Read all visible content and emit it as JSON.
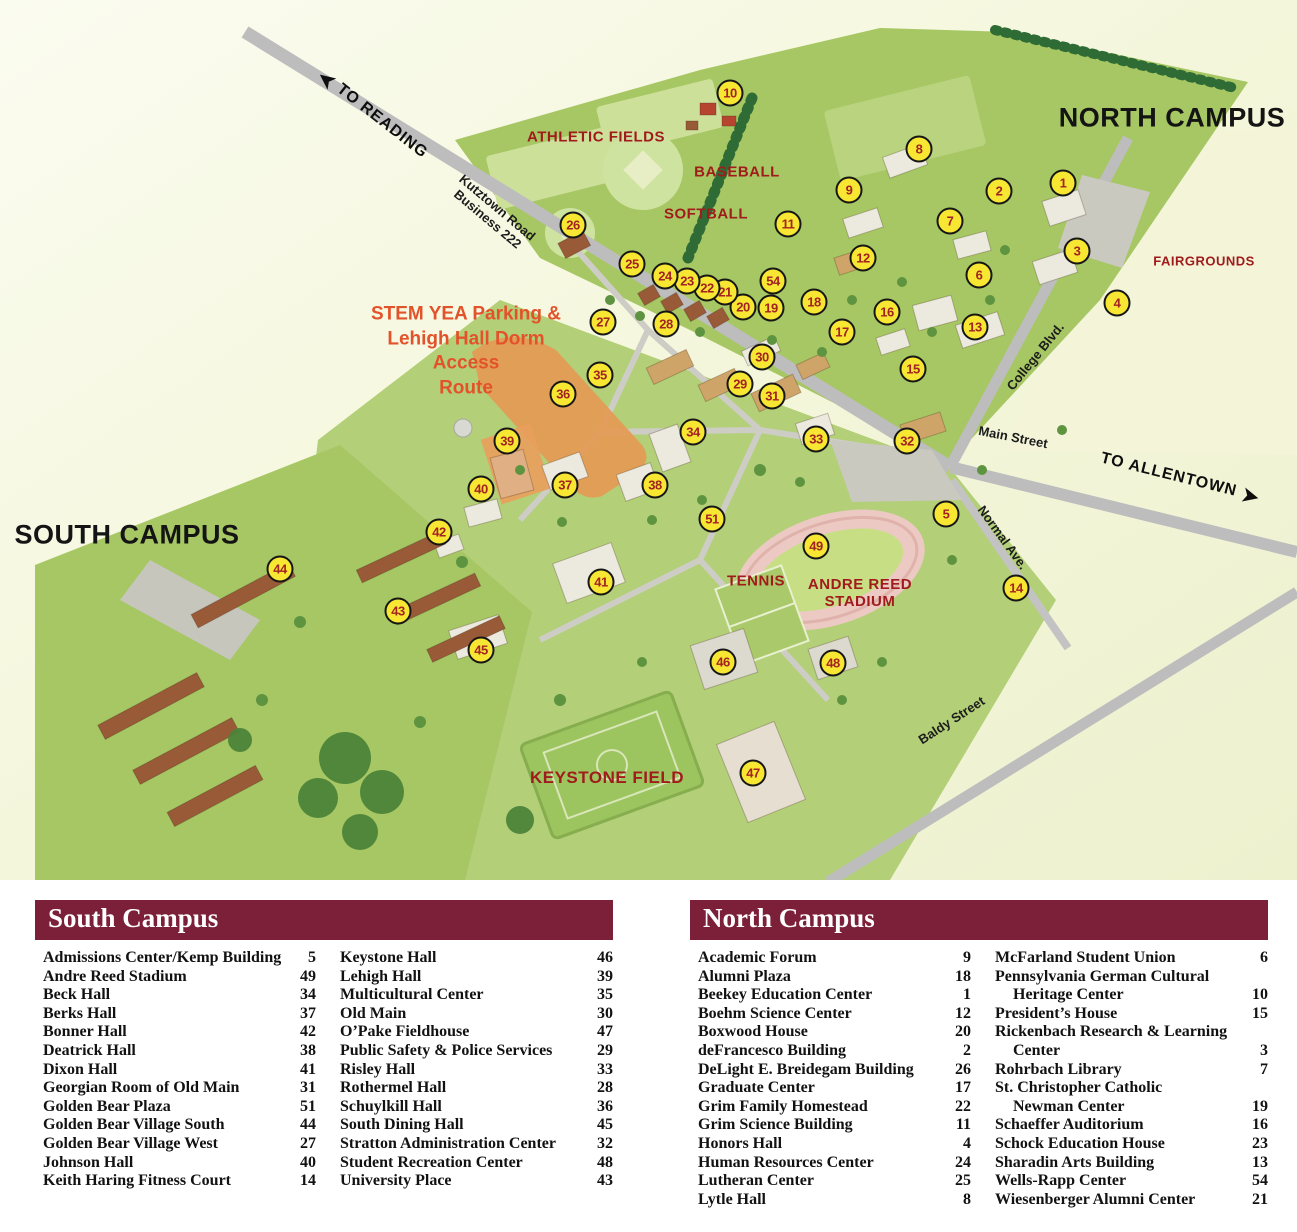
{
  "map": {
    "colors": {
      "marker_fill": "#F7E733",
      "marker_number": "#A32222",
      "red_label": "#A01C1C",
      "stem_orange": "#E2532B",
      "legend_header": "#7C2039",
      "road_gray": "#BDBDBD",
      "green_main": "#A6C763",
      "green_band": "#B3CF78"
    },
    "labels": [
      {
        "lines": [
          "TO READING"
        ],
        "x": 372,
        "y": 115,
        "rot": 38,
        "style": "route",
        "arrow": "before"
      },
      {
        "lines": [
          "Kutztown Road",
          "Business 222"
        ],
        "x": 492,
        "y": 214,
        "rot": 40,
        "style": "street"
      },
      {
        "lines": [
          "NORTH CAMPUS"
        ],
        "x": 1172,
        "y": 118,
        "rot": 0,
        "style": "campus"
      },
      {
        "lines": [
          "ATHLETIC FIELDS"
        ],
        "x": 596,
        "y": 137,
        "rot": 0,
        "style": "red"
      },
      {
        "lines": [
          "BASEBALL"
        ],
        "x": 737,
        "y": 172,
        "rot": 0,
        "style": "red"
      },
      {
        "lines": [
          "SOFTBALL"
        ],
        "x": 706,
        "y": 214,
        "rot": 0,
        "style": "red"
      },
      {
        "lines": [
          "FAIRGROUNDS"
        ],
        "x": 1204,
        "y": 262,
        "rot": 0,
        "style": "red-small"
      },
      {
        "lines": [
          "STEM YEA Parking &",
          "Lehigh Hall Dorm",
          "Access",
          "Route"
        ],
        "x": 466,
        "y": 352,
        "rot": 0,
        "style": "stem"
      },
      {
        "lines": [
          "College Blvd."
        ],
        "x": 1036,
        "y": 357,
        "rot": -51,
        "style": "street"
      },
      {
        "lines": [
          "Main Street"
        ],
        "x": 1013,
        "y": 438,
        "rot": 11,
        "style": "street"
      },
      {
        "lines": [
          "TO ALLENTOWN"
        ],
        "x": 1180,
        "y": 479,
        "rot": 14,
        "style": "route",
        "arrow": "after"
      },
      {
        "lines": [
          "SOUTH CAMPUS"
        ],
        "x": 127,
        "y": 535,
        "rot": 0,
        "style": "campus"
      },
      {
        "lines": [
          "Normal Ave."
        ],
        "x": 1002,
        "y": 538,
        "rot": 54,
        "style": "street"
      },
      {
        "lines": [
          "TENNIS"
        ],
        "x": 756,
        "y": 581,
        "rot": 0,
        "style": "red"
      },
      {
        "lines": [
          "ANDRE REED",
          "STADIUM"
        ],
        "x": 860,
        "y": 593,
        "rot": 0,
        "style": "red"
      },
      {
        "lines": [
          "Baldy Street"
        ],
        "x": 952,
        "y": 721,
        "rot": -33,
        "style": "street"
      },
      {
        "lines": [
          "KEYSTONE FIELD"
        ],
        "x": 607,
        "y": 778,
        "rot": 0,
        "style": "red-big"
      }
    ],
    "markers": [
      {
        "n": "1",
        "x": 1063,
        "y": 183
      },
      {
        "n": "2",
        "x": 999,
        "y": 191
      },
      {
        "n": "3",
        "x": 1077,
        "y": 251
      },
      {
        "n": "4",
        "x": 1117,
        "y": 303
      },
      {
        "n": "5",
        "x": 946,
        "y": 514
      },
      {
        "n": "6",
        "x": 979,
        "y": 275
      },
      {
        "n": "7",
        "x": 950,
        "y": 221
      },
      {
        "n": "8",
        "x": 919,
        "y": 149
      },
      {
        "n": "9",
        "x": 849,
        "y": 190
      },
      {
        "n": "10",
        "x": 730,
        "y": 93
      },
      {
        "n": "11",
        "x": 788,
        "y": 224
      },
      {
        "n": "12",
        "x": 863,
        "y": 258
      },
      {
        "n": "13",
        "x": 975,
        "y": 327
      },
      {
        "n": "14",
        "x": 1016,
        "y": 588
      },
      {
        "n": "15",
        "x": 913,
        "y": 369
      },
      {
        "n": "16",
        "x": 887,
        "y": 312
      },
      {
        "n": "17",
        "x": 842,
        "y": 332
      },
      {
        "n": "18",
        "x": 814,
        "y": 302
      },
      {
        "n": "19",
        "x": 771,
        "y": 308
      },
      {
        "n": "20",
        "x": 743,
        "y": 307
      },
      {
        "n": "21",
        "x": 725,
        "y": 292
      },
      {
        "n": "22",
        "x": 707,
        "y": 288
      },
      {
        "n": "23",
        "x": 687,
        "y": 281
      },
      {
        "n": "24",
        "x": 665,
        "y": 276
      },
      {
        "n": "25",
        "x": 632,
        "y": 264
      },
      {
        "n": "26",
        "x": 573,
        "y": 225
      },
      {
        "n": "27",
        "x": 603,
        "y": 322
      },
      {
        "n": "28",
        "x": 666,
        "y": 324
      },
      {
        "n": "29",
        "x": 740,
        "y": 384
      },
      {
        "n": "30",
        "x": 762,
        "y": 357
      },
      {
        "n": "31",
        "x": 772,
        "y": 396
      },
      {
        "n": "32",
        "x": 907,
        "y": 441
      },
      {
        "n": "33",
        "x": 816,
        "y": 439
      },
      {
        "n": "34",
        "x": 693,
        "y": 432
      },
      {
        "n": "35",
        "x": 600,
        "y": 375
      },
      {
        "n": "36",
        "x": 563,
        "y": 394
      },
      {
        "n": "37",
        "x": 565,
        "y": 485
      },
      {
        "n": "38",
        "x": 655,
        "y": 485
      },
      {
        "n": "39",
        "x": 507,
        "y": 441
      },
      {
        "n": "40",
        "x": 481,
        "y": 489
      },
      {
        "n": "41",
        "x": 601,
        "y": 582
      },
      {
        "n": "42",
        "x": 439,
        "y": 532
      },
      {
        "n": "43",
        "x": 398,
        "y": 611
      },
      {
        "n": "44",
        "x": 280,
        "y": 569
      },
      {
        "n": "45",
        "x": 481,
        "y": 650
      },
      {
        "n": "46",
        "x": 723,
        "y": 662
      },
      {
        "n": "47",
        "x": 753,
        "y": 773
      },
      {
        "n": "48",
        "x": 833,
        "y": 663
      },
      {
        "n": "49",
        "x": 816,
        "y": 546
      },
      {
        "n": "51",
        "x": 712,
        "y": 519
      },
      {
        "n": "54",
        "x": 773,
        "y": 281
      }
    ]
  },
  "legends": [
    {
      "title": "South Campus",
      "columns": [
        [
          {
            "name": "Admissions Center/Kemp Building",
            "num": "5"
          },
          {
            "name": "Andre Reed Stadium",
            "num": "49"
          },
          {
            "name": "Beck Hall",
            "num": "34"
          },
          {
            "name": "Berks Hall",
            "num": "37"
          },
          {
            "name": "Bonner Hall",
            "num": "42"
          },
          {
            "name": "Deatrick Hall",
            "num": "38"
          },
          {
            "name": "Dixon Hall",
            "num": "41"
          },
          {
            "name": "Georgian Room of Old Main",
            "num": "31"
          },
          {
            "name": "Golden Bear Plaza",
            "num": "51"
          },
          {
            "name": "Golden Bear Village South",
            "num": "44"
          },
          {
            "name": "Golden Bear Village West",
            "num": "27"
          },
          {
            "name": "Johnson Hall",
            "num": "40"
          },
          {
            "name": "Keith Haring Fitness Court",
            "num": "14"
          }
        ],
        [
          {
            "name": "Keystone Hall",
            "num": "46"
          },
          {
            "name": "Lehigh Hall",
            "num": "39"
          },
          {
            "name": "Multicultural Center",
            "num": "35"
          },
          {
            "name": "Old Main",
            "num": "30"
          },
          {
            "name": "O’Pake Fieldhouse",
            "num": "47"
          },
          {
            "name": "Public Safety & Police Services",
            "num": "29"
          },
          {
            "name": "Risley Hall",
            "num": "33"
          },
          {
            "name": "Rothermel Hall",
            "num": "28"
          },
          {
            "name": "Schuylkill Hall",
            "num": "36"
          },
          {
            "name": "South Dining Hall",
            "num": "45"
          },
          {
            "name": "Stratton Administration Center",
            "num": "32"
          },
          {
            "name": "Student Recreation Center",
            "num": "48"
          },
          {
            "name": "University Place",
            "num": "43"
          }
        ]
      ]
    },
    {
      "title": "North Campus",
      "columns": [
        [
          {
            "name": "Academic Forum",
            "num": "9"
          },
          {
            "name": "Alumni Plaza",
            "num": "18"
          },
          {
            "name": "Beekey Education Center",
            "num": "1"
          },
          {
            "name": "Boehm Science Center",
            "num": "12"
          },
          {
            "name": "Boxwood House",
            "num": "20"
          },
          {
            "name": "deFrancesco Building",
            "num": "2"
          },
          {
            "name": "DeLight E. Breidegam Building",
            "num": "26"
          },
          {
            "name": "Graduate Center",
            "num": "17"
          },
          {
            "name": "Grim Family Homestead",
            "num": "22"
          },
          {
            "name": "Grim Science Building",
            "num": "11"
          },
          {
            "name": "Honors Hall",
            "num": "4"
          },
          {
            "name": "Human Resources Center",
            "num": "24"
          },
          {
            "name": "Lutheran Center",
            "num": "25"
          },
          {
            "name": "Lytle Hall",
            "num": "8"
          }
        ],
        [
          {
            "name": "McFarland Student Union",
            "num": "6"
          },
          {
            "name": "Pennsylvania German Cultural",
            "name2": "Heritage Center",
            "num": "10"
          },
          {
            "name": "President’s House",
            "num": "15"
          },
          {
            "name": "Rickenbach Research & Learning",
            "name2": "Center",
            "num": "3"
          },
          {
            "name": "Rohrbach Library",
            "num": "7"
          },
          {
            "name": "St. Christopher Catholic",
            "name2": "Newman Center",
            "num": "19"
          },
          {
            "name": "Schaeffer Auditorium",
            "num": "16"
          },
          {
            "name": "Schock Education House",
            "num": "23"
          },
          {
            "name": "Sharadin Arts Building",
            "num": "13"
          },
          {
            "name": "Wells-Rapp Center",
            "num": "54"
          },
          {
            "name": "Wiesenberger Alumni Center",
            "num": "21"
          }
        ]
      ]
    }
  ]
}
